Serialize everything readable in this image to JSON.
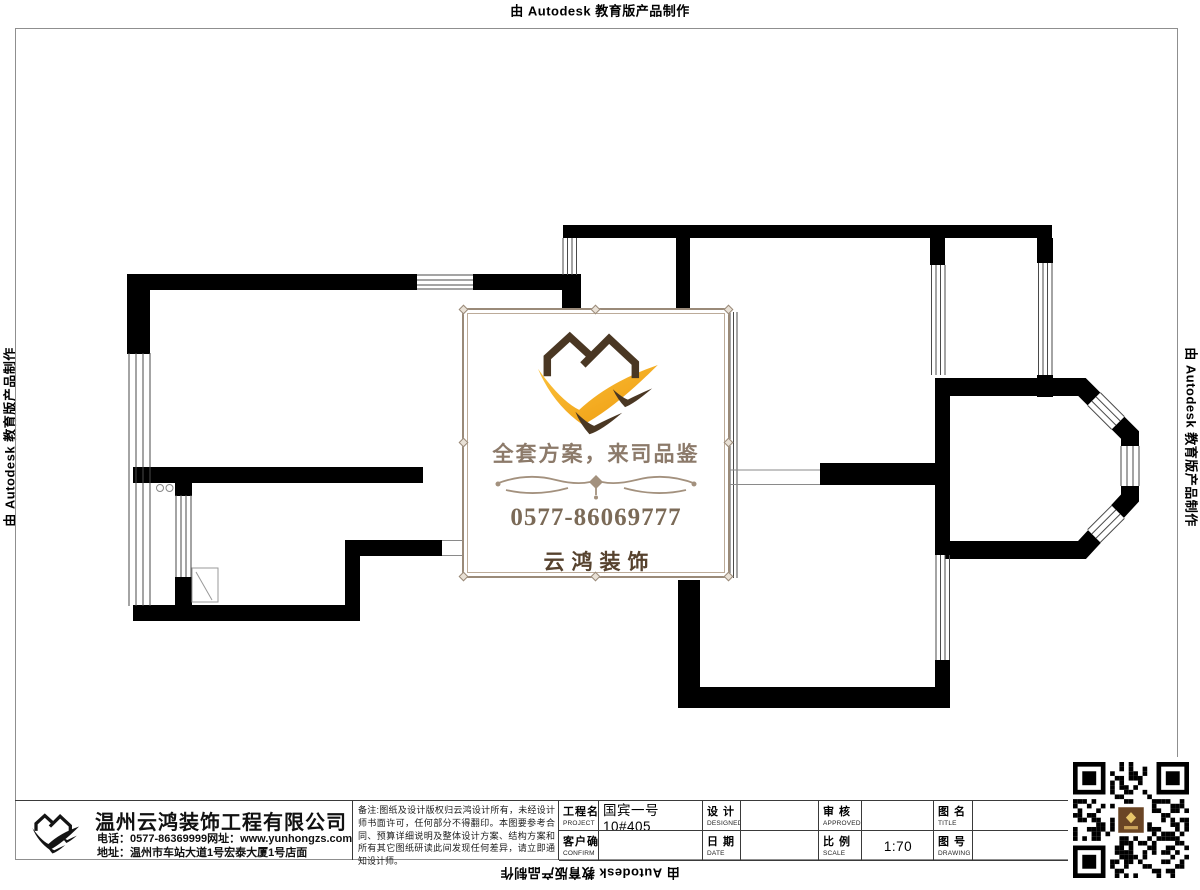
{
  "edge_labels": {
    "top": "由 Autodesk 教育版产品制作",
    "bottom": "由 Autodesk 教育版产品制作",
    "left": "由 Autodesk 教育版产品制作",
    "right": "由 Autodesk 教育版产品制作"
  },
  "stamp": {
    "slogan": "全套方案，来司品鉴",
    "phone": "0577-86069777",
    "brand": "云鸿装饰",
    "logo_icon": "twin-house-swoosh-logo",
    "colors": {
      "frame": "#9a8a79",
      "house_brown": "#4a3723",
      "swoosh_orange": "#f6a71c",
      "slogan_text": "#8c7a6a",
      "phone_text": "#7b6a57",
      "brand_text": "#56422e"
    }
  },
  "title_block": {
    "company": {
      "name": "温州云鸿装饰工程有限公司",
      "phone_line": "电话：0577-86369999网址：www.yunhongzs.com",
      "address_line": "地址：温州市车站大道1号宏泰大厦1号店面",
      "logo_icon": "twin-house-swoosh-logo-black"
    },
    "notes": "备注:图纸及设计版权归云鸿设计所有，未经设计师书面许可，任何部分不得翻印。本图要参考合同、预算详细说明及整体设计方案、结构方案和所有其它图纸研读此间发现任何差异，请立即通知设计师。",
    "fields": [
      {
        "label": "工程名称",
        "sublabel": "PROJECT",
        "value": "国宾一号10#405"
      },
      {
        "label": "客户确认",
        "sublabel": "CONFIRM",
        "value": ""
      },
      {
        "label": "设 计",
        "sublabel": "DESIGNED BY",
        "value": ""
      },
      {
        "label": "日 期",
        "sublabel": "DATE",
        "value": ""
      },
      {
        "label": "审 核",
        "sublabel": "APPROVED BY",
        "value": ""
      },
      {
        "label": "比 例",
        "sublabel": "SCALE",
        "value": "1:70"
      },
      {
        "label": "图 名",
        "sublabel": "TITLE",
        "value": ""
      },
      {
        "label": "图 号",
        "sublabel": "DRAWING NO",
        "value": ""
      }
    ]
  },
  "qr": {
    "icon": "wechat-qr-code",
    "center_logo": "yunhong-brown-seal",
    "module_color": "#000000",
    "center_color": "#6a4525"
  },
  "drawing": {
    "type": "residential floor plan",
    "wall_color": "#000000",
    "window_line_color": "#444444"
  }
}
